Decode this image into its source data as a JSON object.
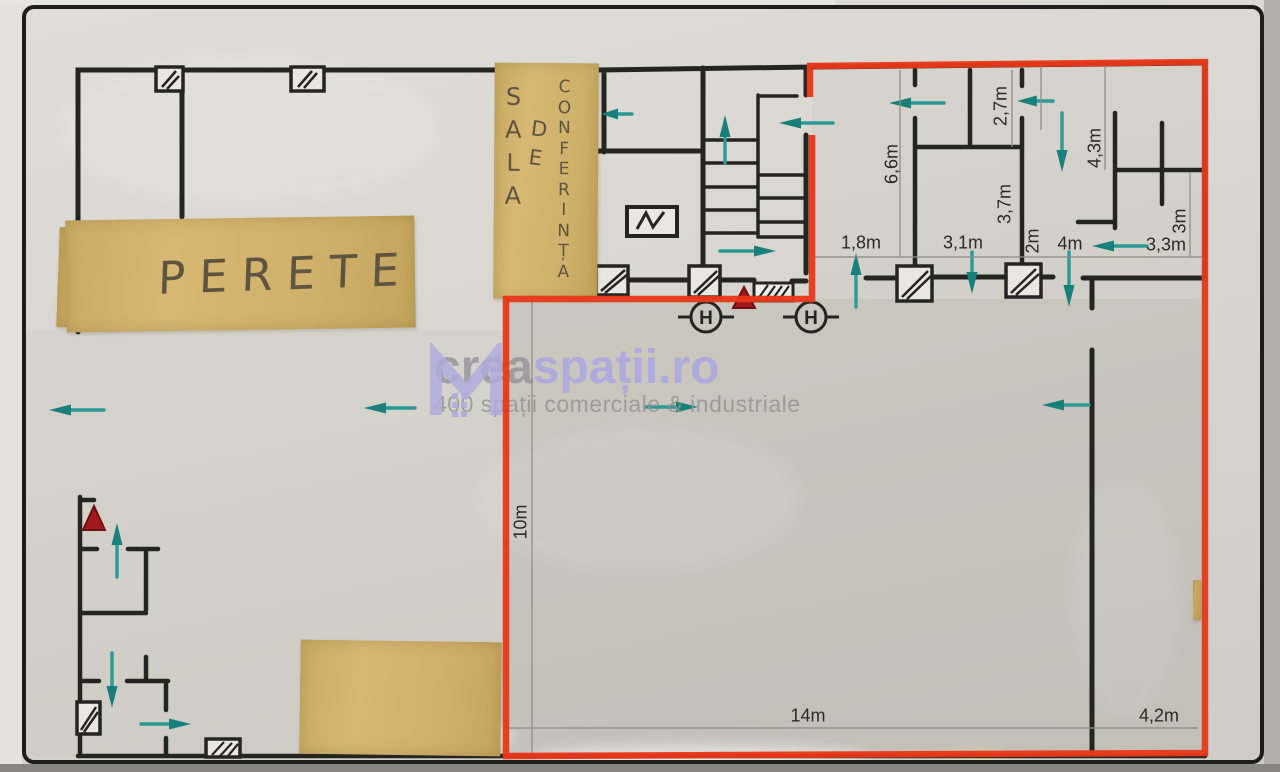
{
  "watermark": {
    "brand_gray": "crea",
    "brand_purple": "spații.ro",
    "tagline": "400 spații comerciale & industriale",
    "purple": "#aba6e4",
    "gray": "#97959b"
  },
  "tapes": {
    "perete_label": "PERETE",
    "sala_word1": "SALA",
    "sala_word2": "DE",
    "sala_word3": "CONFERINȚA"
  },
  "symbols": {
    "hydrant_letter": "H"
  },
  "colors": {
    "highlight_red": "#e8381a",
    "arrow_teal": "#2b9a95",
    "arrow_head_teal": "#17807b",
    "tape_tan": "#d1b26d",
    "wall_black": "#242420",
    "dimension_text": "#2a2a27"
  },
  "dimensions": [
    {
      "text": "6,6m",
      "x": 892,
      "y": 164,
      "rot": -90
    },
    {
      "text": "2,7m",
      "x": 1001,
      "y": 106,
      "rot": -90
    },
    {
      "text": "4,3m",
      "x": 1095,
      "y": 148,
      "rot": -90
    },
    {
      "text": "3,7m",
      "x": 1005,
      "y": 204,
      "rot": -90
    },
    {
      "text": "2m",
      "x": 1033,
      "y": 241,
      "rot": -90
    },
    {
      "text": "3m",
      "x": 1180,
      "y": 221,
      "rot": -90
    },
    {
      "text": "1,8m",
      "x": 861,
      "y": 243,
      "rot": 0
    },
    {
      "text": "3,1m",
      "x": 963,
      "y": 243,
      "rot": 0
    },
    {
      "text": "4m",
      "x": 1070,
      "y": 244,
      "rot": 0
    },
    {
      "text": "3,3m",
      "x": 1166,
      "y": 245,
      "rot": 0
    },
    {
      "text": "10m",
      "x": 521,
      "y": 522,
      "rot": -90
    },
    {
      "text": "14m",
      "x": 808,
      "y": 716,
      "rot": 0
    },
    {
      "text": "4,2m",
      "x": 1159,
      "y": 716,
      "rot": 0
    }
  ],
  "arrows": [
    {
      "x1": 632,
      "y1": 114,
      "x2": 601,
      "y2": 114
    },
    {
      "x1": 725,
      "y1": 163,
      "x2": 725,
      "y2": 115
    },
    {
      "x1": 833,
      "y1": 123,
      "x2": 779,
      "y2": 123
    },
    {
      "x1": 944,
      "y1": 103,
      "x2": 889,
      "y2": 103
    },
    {
      "x1": 1053,
      "y1": 101,
      "x2": 1017,
      "y2": 101
    },
    {
      "x1": 1062,
      "y1": 113,
      "x2": 1062,
      "y2": 172
    },
    {
      "x1": 856,
      "y1": 307,
      "x2": 856,
      "y2": 253
    },
    {
      "x1": 972,
      "y1": 252,
      "x2": 972,
      "y2": 294
    },
    {
      "x1": 1069,
      "y1": 252,
      "x2": 1069,
      "y2": 307
    },
    {
      "x1": 1147,
      "y1": 246,
      "x2": 1092,
      "y2": 246
    },
    {
      "x1": 1089,
      "y1": 405,
      "x2": 1042,
      "y2": 405
    },
    {
      "x1": 720,
      "y1": 251,
      "x2": 776,
      "y2": 251
    },
    {
      "x1": 646,
      "y1": 407,
      "x2": 698,
      "y2": 407
    },
    {
      "x1": 104,
      "y1": 410,
      "x2": 49,
      "y2": 410
    },
    {
      "x1": 415,
      "y1": 408,
      "x2": 364,
      "y2": 408
    },
    {
      "x1": 117,
      "y1": 577,
      "x2": 117,
      "y2": 523
    },
    {
      "x1": 112,
      "y1": 653,
      "x2": 112,
      "y2": 708
    },
    {
      "x1": 141,
      "y1": 724,
      "x2": 191,
      "y2": 724
    }
  ]
}
